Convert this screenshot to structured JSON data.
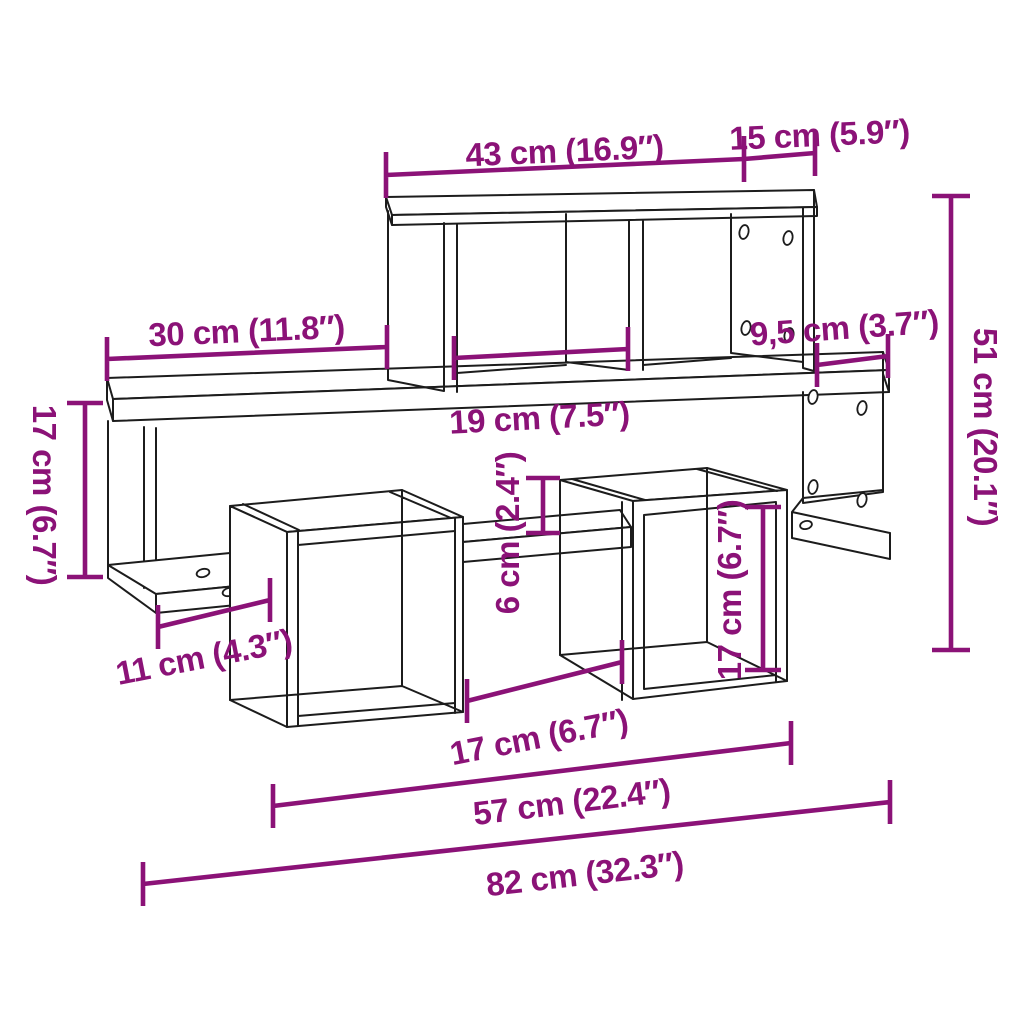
{
  "diagram": {
    "kind": "furniture-dimension-diagram",
    "subject": "wall-mounted cube shelf, 3D line drawing",
    "colors": {
      "background": "#FFFFFF",
      "outline": "#1C1C1C",
      "dimension": "#8B1277"
    }
  },
  "dimensions": {
    "top_shelf_width": "43 cm (16.9″)",
    "top_right_compartment_width": "15 cm (5.9″)",
    "left_shelf_overhang": "30 cm (11.8″)",
    "compartment_width": "19 cm (7.5″)",
    "right_shelf_overhang": "9,5 cm (3.7″)",
    "total_height": "51 cm (20.1″)",
    "left_section_height": "17 cm (6.7″)",
    "shelf_gap_height": "6 cm (2.4″)",
    "right_cube_height": "17 cm (6.7″)",
    "bottom_left_shelf_width": "11 cm (4.3″)",
    "cube_spacing_width": "17 cm (6.7″)",
    "lower_section_width": "57 cm (22.4″)",
    "total_width": "82 cm (32.3″)"
  }
}
